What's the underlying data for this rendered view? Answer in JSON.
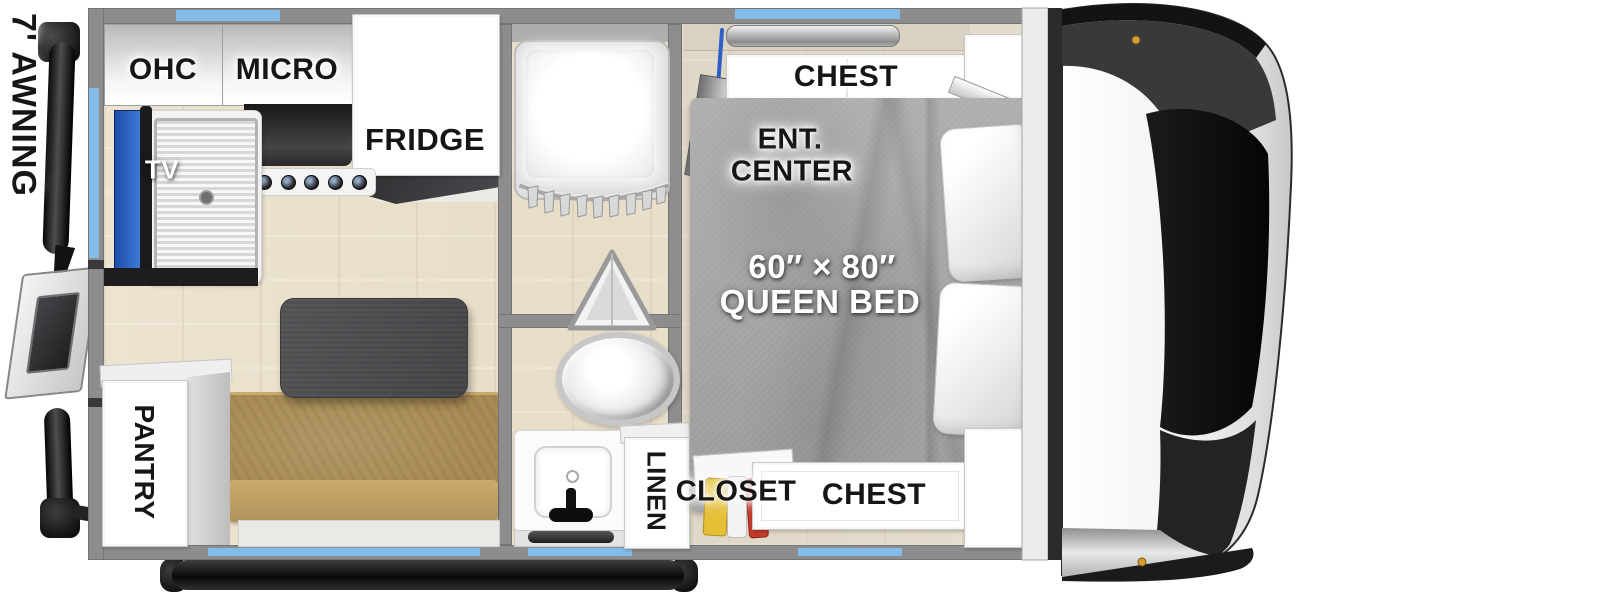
{
  "exterior": {
    "awning_label": "7' AWNING"
  },
  "kitchen": {
    "ohc_label": "OHC",
    "micro_label": "MICRO",
    "fridge_label": "FRIDGE",
    "tv_label": "TV",
    "pantry_label": "PANTRY"
  },
  "bath": {
    "linen_label": "LINEN"
  },
  "bedroom": {
    "chest_top_label": "CHEST",
    "ent_center_line1": "ENT.",
    "ent_center_line2": "CENTER",
    "bed_size": "60″ × 80″",
    "bed_type": "QUEEN BED",
    "closet_label": "CLOSET",
    "chest_bottom_label": "CHEST"
  },
  "colors": {
    "wall": "#8d8d8d",
    "window_blue": "#84bce9",
    "floor_wood": "#ebe2cf",
    "bed_gray": "#a7a7a7",
    "bench_tan": "#a98c55",
    "table_dark": "#4b4b4e",
    "tv_screen_blue": "#2f6fd0",
    "marker_light_amber": "#d79a2c"
  }
}
